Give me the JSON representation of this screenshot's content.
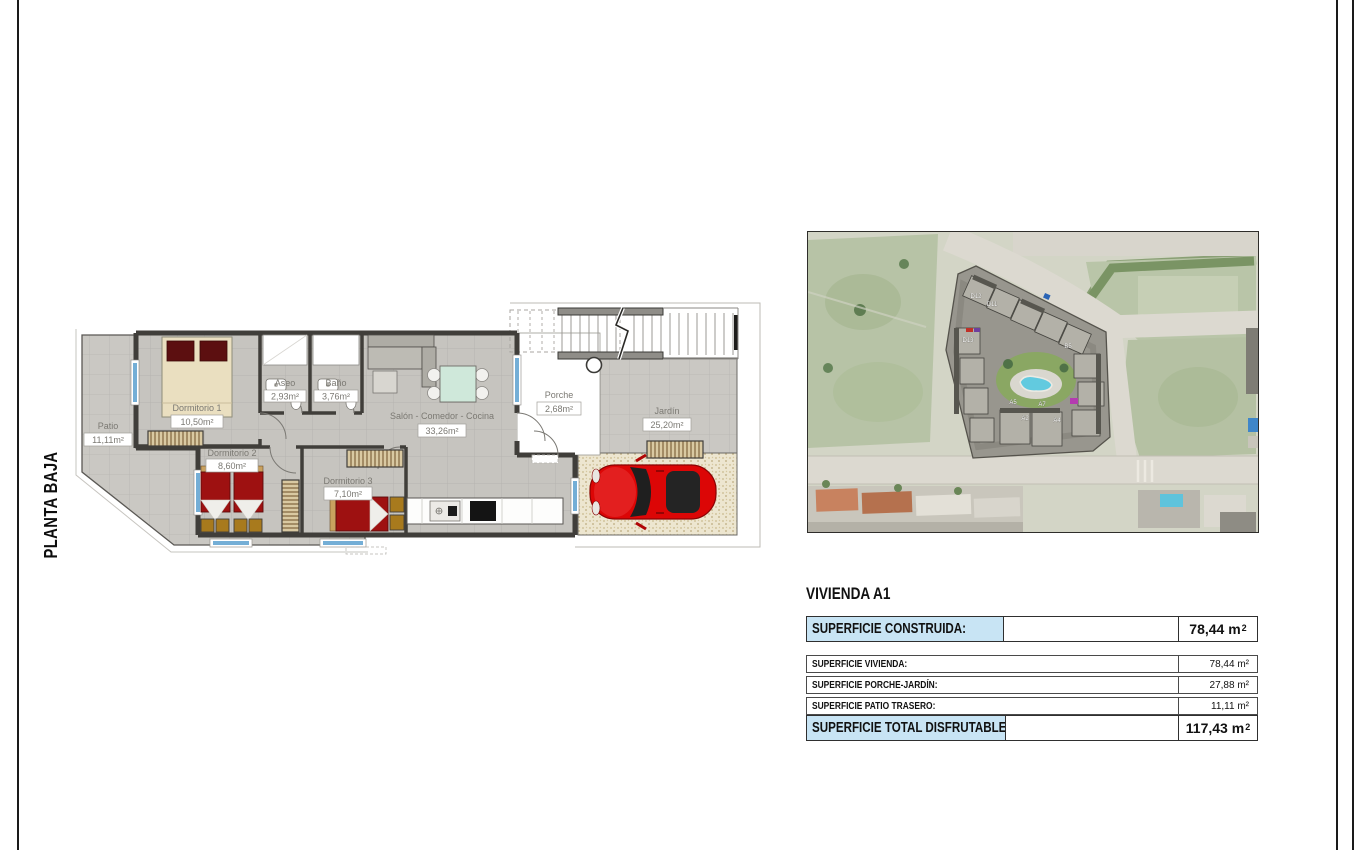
{
  "page": {
    "sheet_label": "PLANTA BAJA"
  },
  "floor_plan": {
    "rooms": [
      {
        "name": "Patio",
        "area": "11,11m²"
      },
      {
        "name": "Dormitorio 1",
        "area": "10,50m²"
      },
      {
        "name": "Aseo",
        "area": "2,93m²"
      },
      {
        "name": "Baño",
        "area": "3,76m²"
      },
      {
        "name": "Salón - Comedor - Cocina",
        "area": "33,26m²"
      },
      {
        "name": "Dormitorio 2",
        "area": "8,60m²"
      },
      {
        "name": "Dormitorio 3",
        "area": "7,10m²"
      },
      {
        "name": "Porche",
        "area": "2,68m²"
      },
      {
        "name": "Jardín",
        "area": "25,20m²"
      }
    ]
  },
  "site_map": {
    "unit_labels": [
      "D12",
      "D11",
      "D13",
      "B5",
      "A5",
      "A2",
      "A7",
      "A4"
    ]
  },
  "summary": {
    "title": "VIVIENDA A1",
    "construida": {
      "label": "SUPERFICIE CONSTRUIDA:",
      "value": "78,44 m",
      "sup": "2"
    },
    "rows": [
      {
        "label": "SUPERFICIE VIVIENDA:",
        "value": "78,44 m²"
      },
      {
        "label": "SUPERFICIE PORCHE-JARDÍN:",
        "value": "27,88 m²"
      },
      {
        "label": "SUPERFICIE PATIO TRASERO:",
        "value": "11,11 m²"
      }
    ],
    "total": {
      "label": "SUPERFICIE TOTAL DISFRUTABLE:",
      "value": "117,43 m",
      "sup": "2"
    }
  },
  "colors": {
    "highlight_blue": "#c8e4f4",
    "bed_red": "#9e1111",
    "car_red": "#dc0606",
    "window_blue": "#74aed6",
    "pool_blue": "#62cadf",
    "tile_grey": "#cac8c3"
  }
}
